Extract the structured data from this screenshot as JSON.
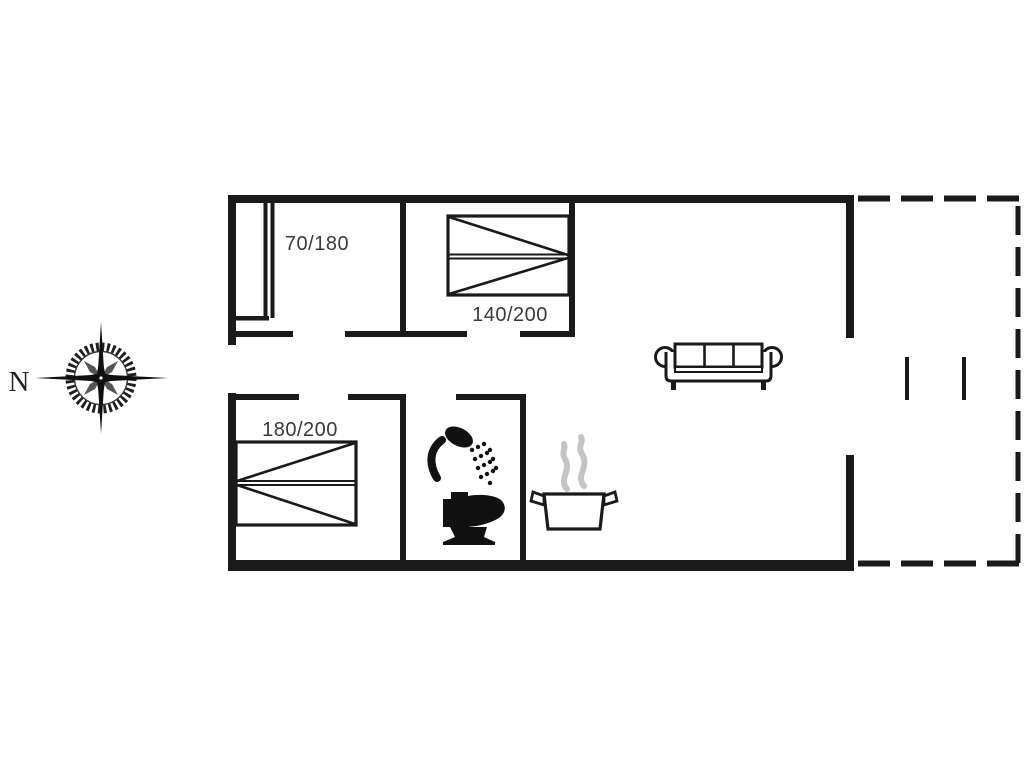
{
  "diagram_type": "holiday-house-floor-plan",
  "compass": {
    "north_label": "N"
  },
  "labels": {
    "bed_small": "70/180",
    "bed_double": "140/200",
    "bed_master": "180/200"
  },
  "rooms": [
    {
      "name": "bedroom-small",
      "bed_size_cm": "70/180"
    },
    {
      "name": "bedroom-double",
      "bed_size_cm": "140/200"
    },
    {
      "name": "bedroom-master",
      "bed_size_cm": "180/200"
    },
    {
      "name": "bathroom",
      "fixtures": [
        "shower",
        "toilet"
      ]
    },
    {
      "name": "kitchen",
      "fixtures": [
        "cooking-pot-with-steam"
      ]
    },
    {
      "name": "living-room",
      "fixtures": [
        "sofa"
      ]
    },
    {
      "name": "terrace",
      "style": "dashed-outline"
    }
  ],
  "icons": [
    "compass-rose-icon",
    "single-bed-icon",
    "double-bed-icon",
    "master-bed-icon",
    "sofa-icon",
    "shower-icon",
    "toilet-icon",
    "cooking-pot-icon",
    "steam-icon"
  ],
  "colors": {
    "wall": "#1a1a1a",
    "text": "#3a3a3a",
    "steam": "#c4c4c4",
    "background": "#ffffff"
  }
}
